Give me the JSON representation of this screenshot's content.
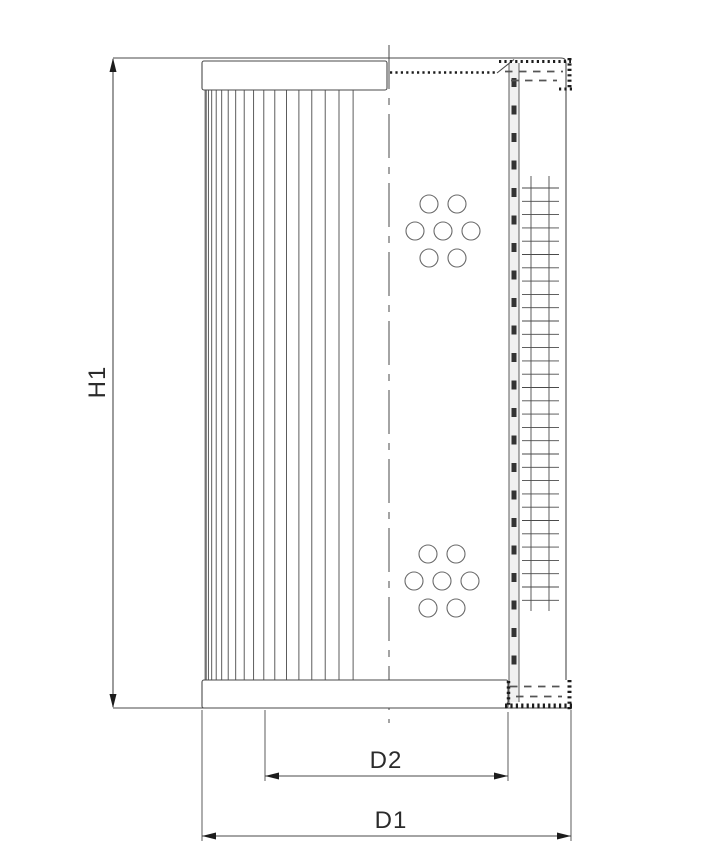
{
  "dimension_labels": {
    "height": "H1",
    "core_diameter": "D2",
    "outer_diameter": "D1"
  },
  "colors": {
    "background": "#ffffff",
    "line": "#4a4a4a",
    "accent_dark": "#1c1c1c",
    "text": "#2b2b2b",
    "hole": "#6a6a6a"
  }
}
